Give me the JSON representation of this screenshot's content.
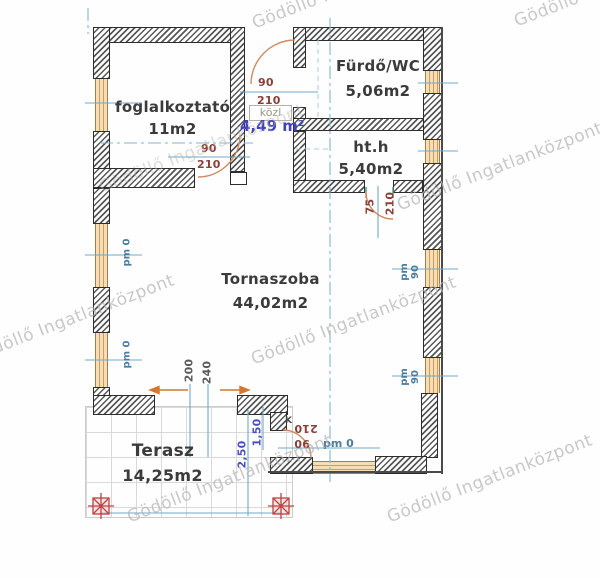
{
  "watermark": {
    "text": "Gödöllő Ingatlanközpont"
  },
  "rooms": {
    "foglalkoztato": {
      "name": "foglalkoztató",
      "area": "11m2"
    },
    "furdo_wc": {
      "name": "Fürdő/WC",
      "area": "5,06m2"
    },
    "haztartasi": {
      "name": "ht.h",
      "area": "5,40m2"
    },
    "tornaszoba": {
      "name": "Tornaszoba",
      "area": "44,02m2"
    },
    "terasz": {
      "name": "Terasz",
      "area": "14,25m2"
    },
    "kozlekedo": {
      "name": "közl",
      "area": "4,49 m²"
    }
  },
  "doors": {
    "kozl_furdo": {
      "width": "90",
      "height": "210"
    },
    "foglalkoztato_torna": {
      "width": "90",
      "height": "210"
    },
    "torna_hth": {
      "width": "75",
      "height": "210"
    },
    "torna_terasz": {
      "width": "90",
      "height": "210"
    },
    "marker": "K"
  },
  "windows": {
    "parapet_left_upper": "pm 0",
    "parapet_left_lower": "pm 0",
    "parapet_right_upper": "pm 90",
    "parapet_right_lower": "pm 90",
    "parapet_terrace_door": "pm 0"
  },
  "openings": {
    "width_1": "200",
    "width_2": "240"
  },
  "terrace_dims": {
    "depth": "2,50",
    "offset": "1,50"
  },
  "colors": {
    "wall_hatch": "#585858",
    "window_fill": "#f5deb6",
    "dimension_red": "#8a4038",
    "dimension_blue": "#4a4fc4",
    "axis_teal": "#6fa9c9",
    "door_arc": "#cf8a62",
    "column_red": "#c24040",
    "watermark_gray": "#b4b4b4"
  }
}
